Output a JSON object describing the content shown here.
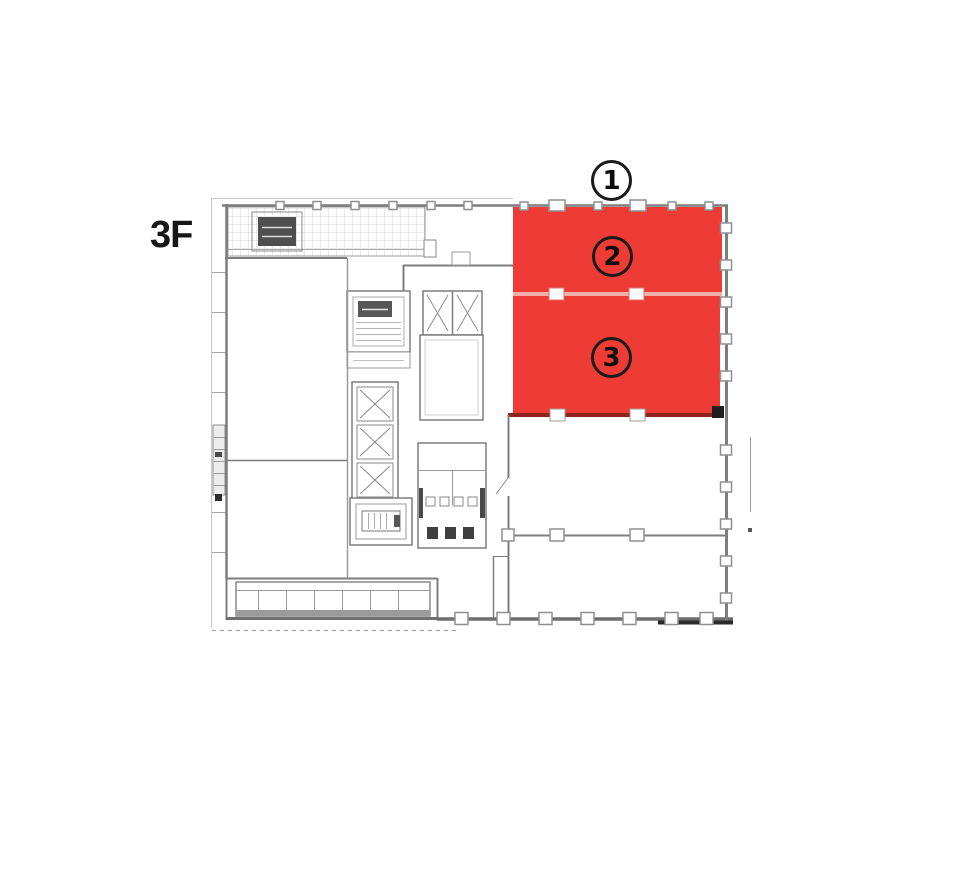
{
  "floor_plan": {
    "floor_label": "3F",
    "highlight_color": "#ee3b35",
    "divider_color": "#f2aea9",
    "units": [
      {
        "number": "1",
        "highlighted": false
      },
      {
        "number": "2",
        "highlighted": true
      },
      {
        "number": "3",
        "highlighted": true
      }
    ]
  }
}
